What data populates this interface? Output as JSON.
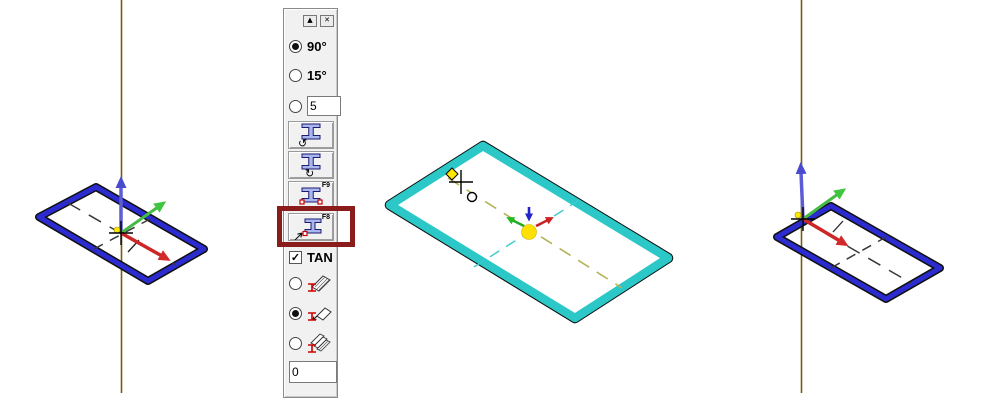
{
  "palette": {
    "titlebar": {
      "collapse_glyph": "▲",
      "close_glyph": "✕"
    },
    "angle_options": [
      {
        "label": "90°",
        "selected": true
      },
      {
        "label": "15°",
        "selected": false
      }
    ],
    "custom_angle": {
      "value": "5",
      "selected": false
    },
    "rotate_buttons": [
      {
        "name": "rotate-profile-ccw",
        "glyph": "↺",
        "fkey": ""
      },
      {
        "name": "rotate-profile-cw",
        "glyph": "↻",
        "fkey": ""
      },
      {
        "name": "profile-both-endpoints",
        "glyph": "",
        "fkey": "F9"
      },
      {
        "name": "profile-single-point",
        "glyph": "",
        "fkey": "F8",
        "highlighted": true
      }
    ],
    "tangent_checkbox": {
      "label": "TAN",
      "checked": true,
      "check_glyph": "✓"
    },
    "placement_options": [
      {
        "name": "profile-along-beam",
        "selected": false
      },
      {
        "name": "profile-fold",
        "selected": true
      },
      {
        "name": "profile-multi-beam",
        "selected": false
      }
    ],
    "offset_field": {
      "value": "0"
    }
  },
  "annotation": {
    "highlight_color": "#8b1c1c"
  },
  "viewport": {
    "left_view": {
      "profile_color": "#2b2bcf",
      "axis_line_color": "#7a5a14",
      "origin_color": "#ffe800",
      "triad": {
        "x_color": "#cc2626",
        "y_color": "#44bb44",
        "z_color": "#5c5cd6"
      }
    },
    "center_view": {
      "profile_color": "#2cc7c7",
      "centerline_long_color": "#b3b35a",
      "centerline_short_color": "#3cc9c9",
      "origin_color": "#ffe000"
    },
    "right_view": {
      "profile_color": "#2b2bcf",
      "axis_line_color": "#7a5a14",
      "origin_color": "#ffe800",
      "triad": {
        "x_color": "#cc2626",
        "y_color": "#44bb44",
        "z_color": "#5c5cd6"
      }
    }
  }
}
